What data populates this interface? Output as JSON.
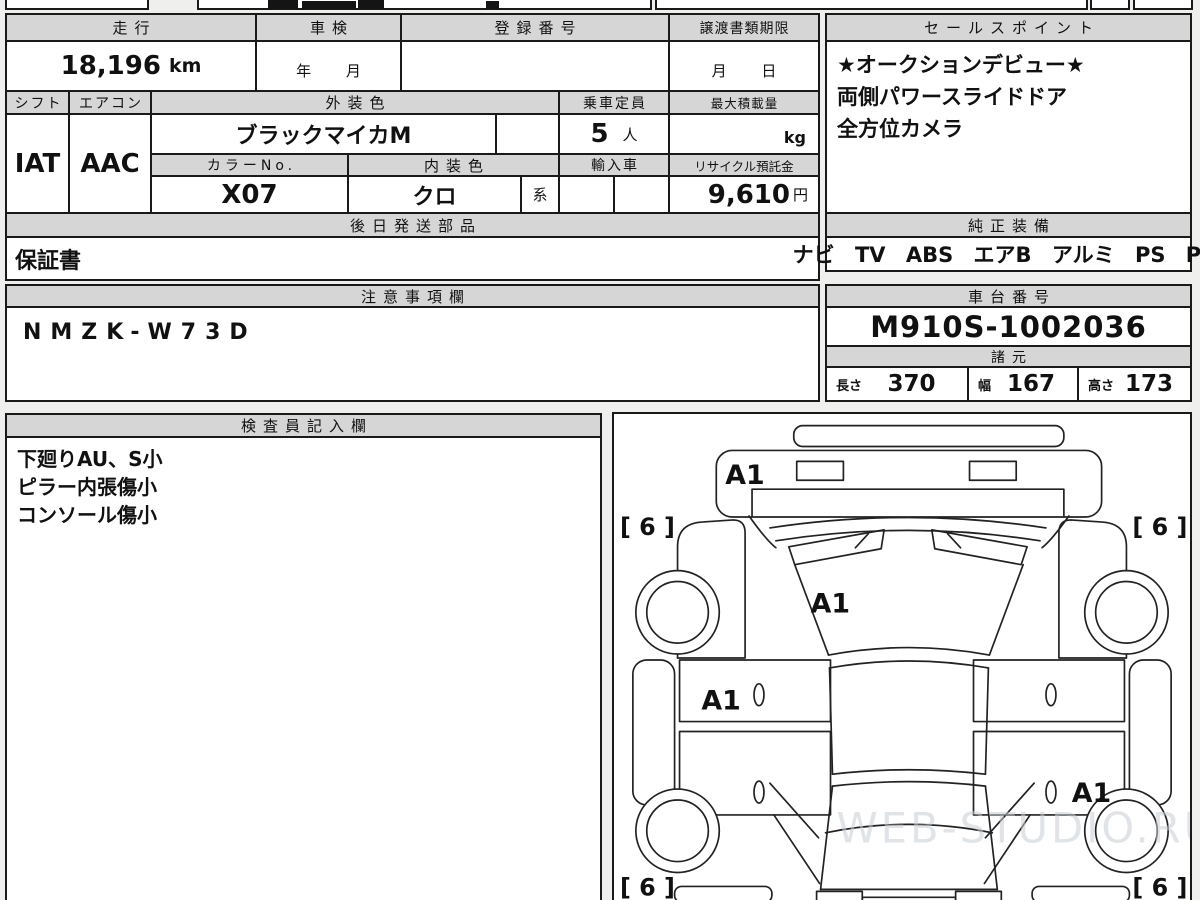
{
  "fields": {
    "mileage": {
      "label": "走行",
      "value": "18,196",
      "unit": "km"
    },
    "inspection": {
      "label": "車検",
      "value": "年 月"
    },
    "registration_no": {
      "label": "登録番号",
      "value": ""
    },
    "transfer_deadline": {
      "label": "譲渡書類期限",
      "value": "月 日"
    },
    "shift": {
      "label": "シフト",
      "value": "IAT"
    },
    "aircon": {
      "label": "エアコン",
      "value": "AAC"
    },
    "exterior_color": {
      "label": "外装色",
      "value": "ブラックマイカM"
    },
    "capacity": {
      "label": "乗車定員",
      "value": "5",
      "unit": "人"
    },
    "max_load": {
      "label": "最大積載量",
      "unit": "kg"
    },
    "color_no": {
      "label": "カラーNo.",
      "value": "X07"
    },
    "interior_color": {
      "label": "内装色",
      "value": "クロ",
      "suffix": "系"
    },
    "import_car": {
      "label": "輸入車",
      "value": ""
    },
    "recycle_deposit": {
      "label": "リサイクル預託金",
      "value": "9,610",
      "unit": "円"
    },
    "later_parts": {
      "label": "後日発送部品",
      "value": "保証書"
    },
    "caution": {
      "label": "注意事項欄",
      "value": "NMZK-W73D"
    }
  },
  "sales_points": {
    "label": "セールスポイント",
    "lines": [
      "★オークションデビュー★",
      "両側パワースライドドア",
      "全方位カメラ"
    ]
  },
  "equipment": {
    "label": "純正装備",
    "value": "ナビ TV ABS エアB アルミ PS PW"
  },
  "chassis_no": {
    "label": "車台番号",
    "value": "M910S-1002036"
  },
  "specs": {
    "label": "諸元",
    "length_label": "長さ",
    "length": "370",
    "width_label": "幅",
    "width": "167",
    "height_label": "高さ",
    "height": "173"
  },
  "inspector": {
    "label": "検査員記入欄",
    "lines": [
      "下廻りAU、S小",
      "ピラー内張傷小",
      "コンソール傷小"
    ]
  },
  "diagram": {
    "marks": {
      "front_bumper": "A1",
      "windshield": "A1",
      "left_front_door": "A1",
      "right_rear_door": "A1"
    },
    "tires": {
      "front_left": "[ 6 ]",
      "front_right": "[ 6 ]",
      "rear_left": "[ 6 ]",
      "rear_right": "[ 6 ]"
    },
    "watermark": "WEB-STUDIO.RU"
  }
}
